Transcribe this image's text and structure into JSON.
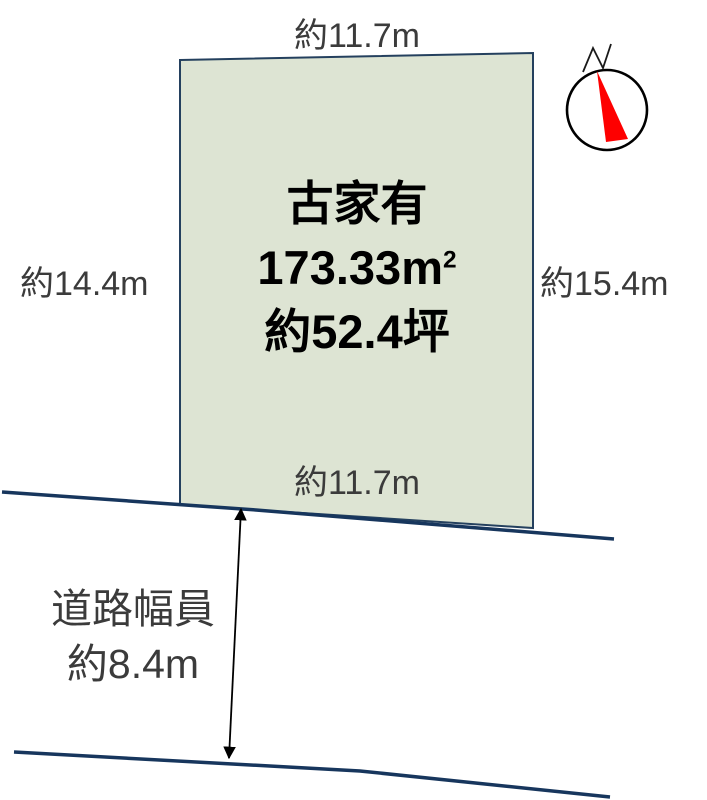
{
  "diagram": {
    "plot": {
      "top_dimension": "約11.7m",
      "left_dimension": "約14.4m",
      "right_dimension": "約15.4m",
      "bottom_dimension": "約11.7m",
      "building_status": "古家有",
      "area_value": "173.33",
      "area_unit": "m",
      "area_unit_exponent": "2",
      "area_tsubo": "約52.4坪",
      "fill_color": "#dde4d3",
      "border_color": "#24405e"
    },
    "road": {
      "width_label_line1": "道路幅員",
      "width_label_line2": "約8.4m",
      "edge_color": "#17365d"
    },
    "compass": {
      "north_label": "N",
      "needle_color": "#fe0000",
      "ring_color": "#000000"
    }
  }
}
